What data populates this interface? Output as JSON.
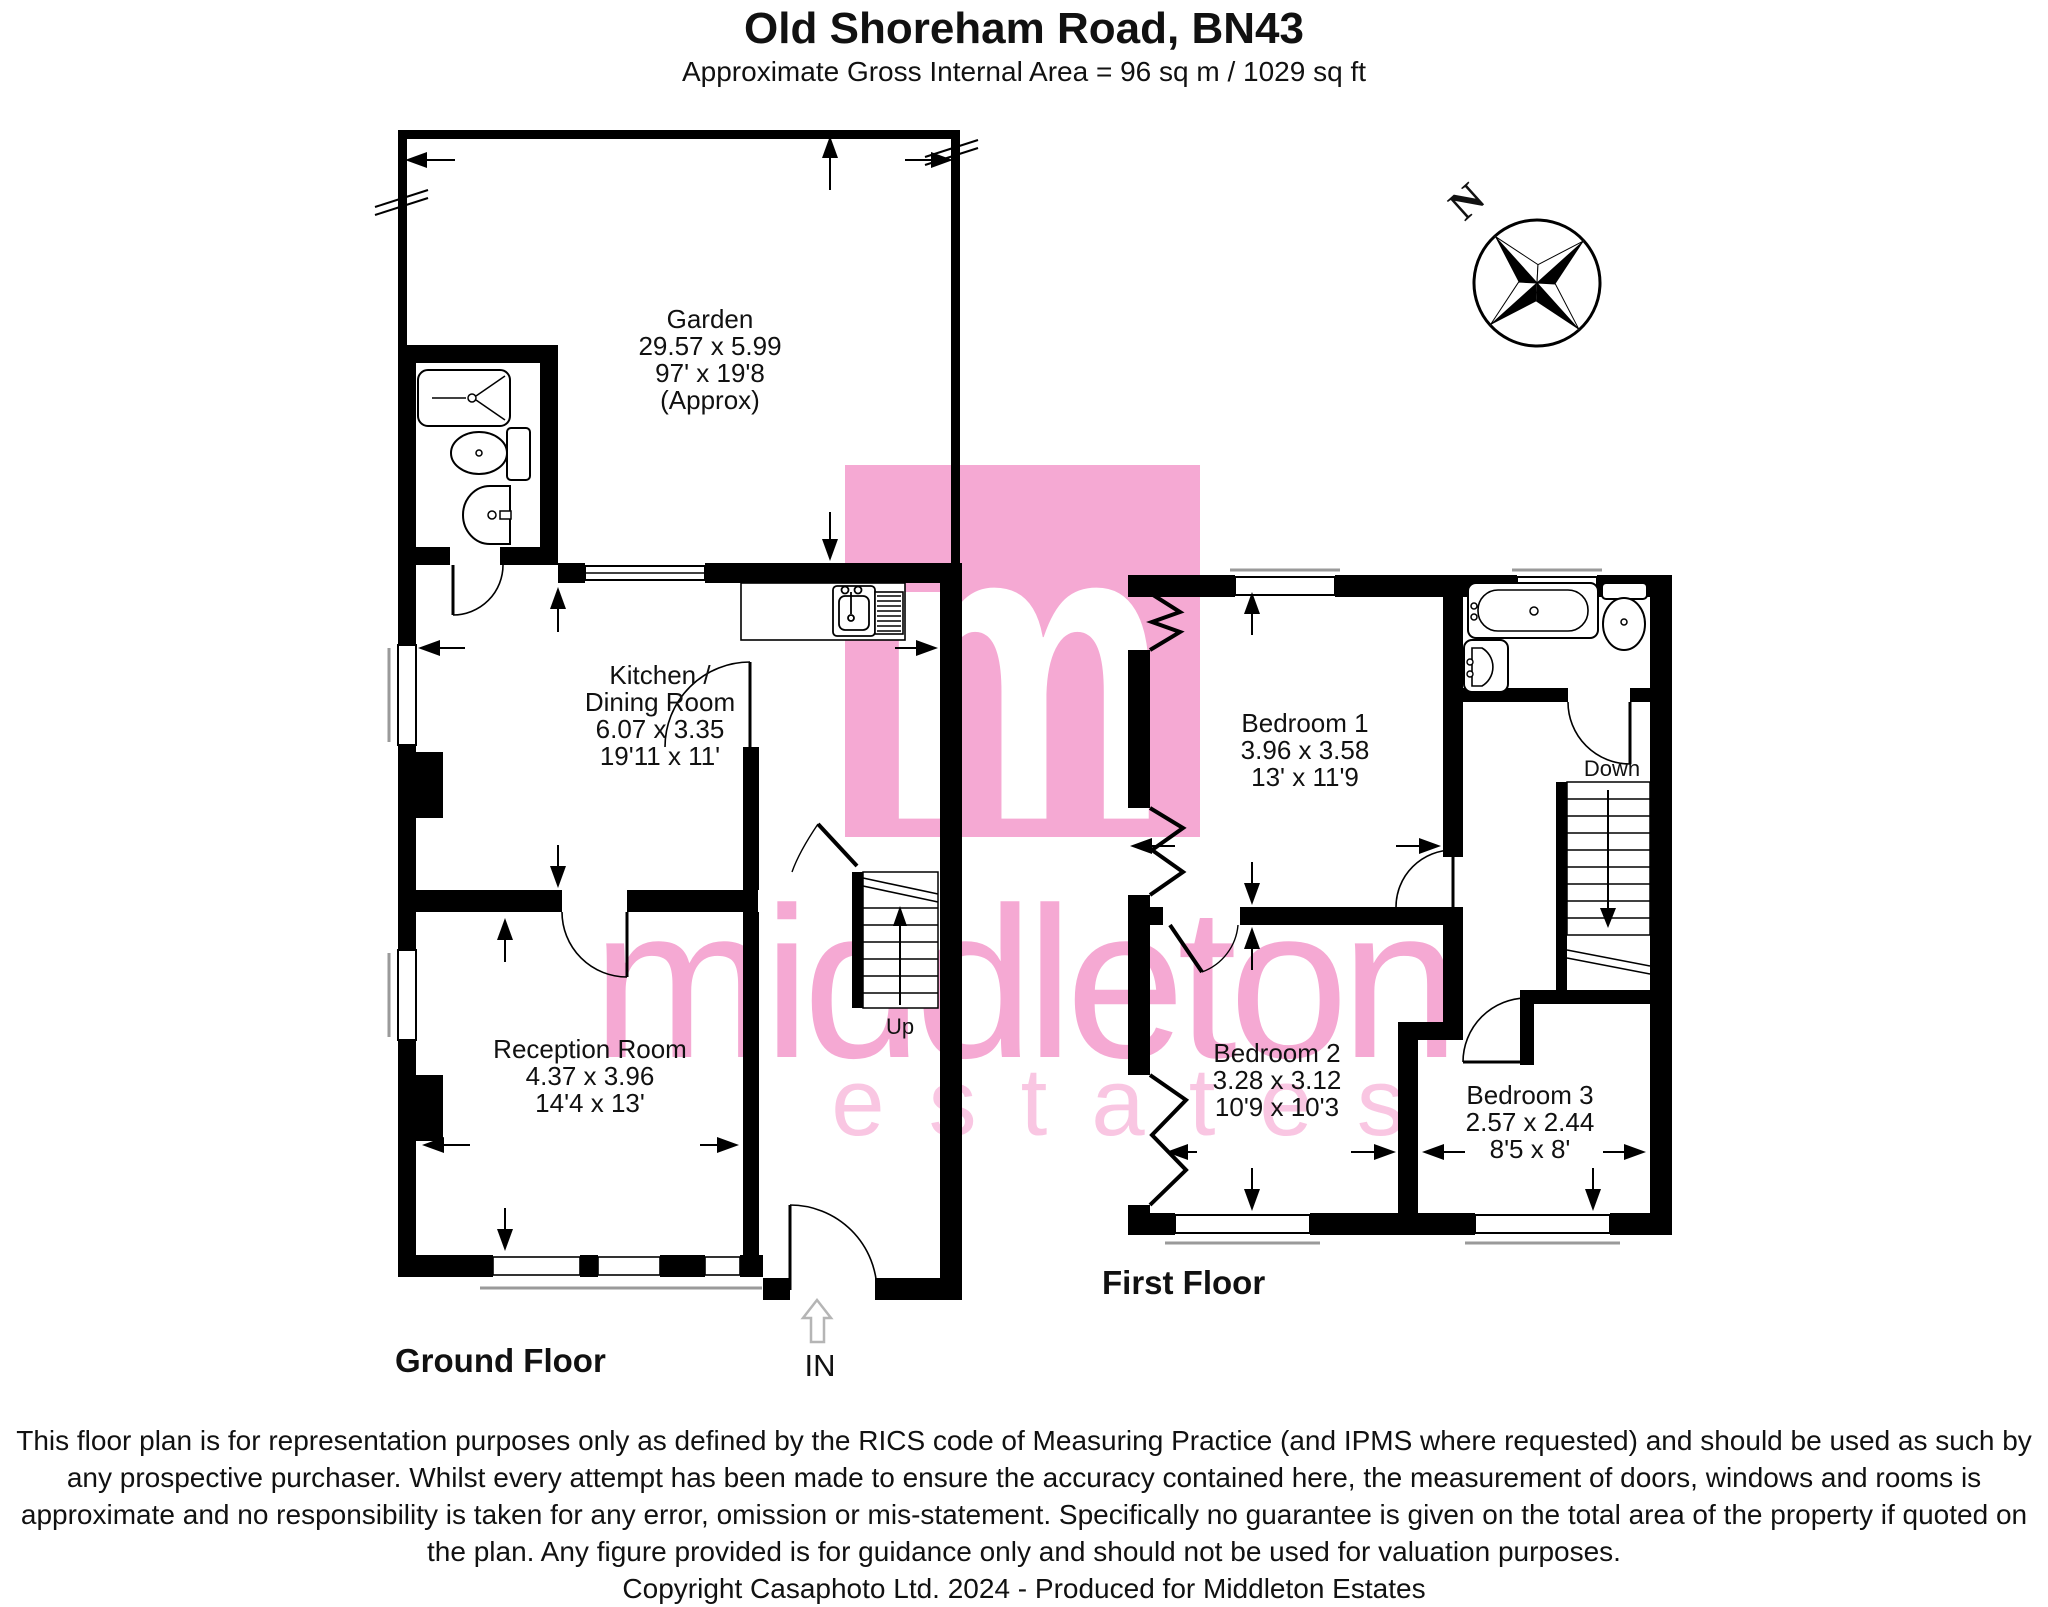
{
  "header": {
    "title": "Old Shoreham Road, BN43",
    "subtitle": "Approximate Gross Internal Area = 96 sq m / 1029 sq ft"
  },
  "compass": {
    "north_label": "N"
  },
  "watermark": {
    "logo_letter": "m",
    "brand": "middleton",
    "tagline": "estates",
    "pink": "#f5a9d3",
    "pink_light": "#f9c6e2"
  },
  "ground_floor": {
    "label": "Ground Floor",
    "entrance_label": "IN",
    "stairs_label": "Up",
    "garden": {
      "name": "Garden",
      "metric": "29.57 x 5.99",
      "imperial": "97' x 19'8",
      "approx": "(Approx)"
    },
    "kitchen": {
      "name_line1": "Kitchen /",
      "name_line2": "Dining Room",
      "metric": "6.07 x 3.35",
      "imperial": "19'11 x 11'"
    },
    "reception": {
      "name": "Reception Room",
      "metric": "4.37 x 3.96",
      "imperial": "14'4 x 13'"
    }
  },
  "first_floor": {
    "label": "First Floor",
    "stairs_label": "Down",
    "bedroom1": {
      "name": "Bedroom 1",
      "metric": "3.96 x 3.58",
      "imperial": "13' x 11'9"
    },
    "bedroom2": {
      "name": "Bedroom 2",
      "metric": "3.28 x 3.12",
      "imperial": "10'9 x 10'3"
    },
    "bedroom3": {
      "name": "Bedroom 3",
      "metric": "2.57 x 2.44",
      "imperial": "8'5 x 8'"
    }
  },
  "footer": {
    "disclaimer": "This floor plan is for representation purposes only as defined by the RICS code of Measuring Practice (and IPMS where requested) and should be used as such by any prospective purchaser. Whilst every attempt has been made to ensure the accuracy contained here, the measurement of doors, windows and rooms is approximate and no responsibility is taken for any error, omission or mis-statement. Specifically no guarantee is given on the total area of the property if quoted on the plan. Any figure provided is for guidance only and should not be used for valuation purposes.",
    "copyright": "Copyright Casaphoto Ltd. 2024 - Produced for Middleton Estates"
  }
}
